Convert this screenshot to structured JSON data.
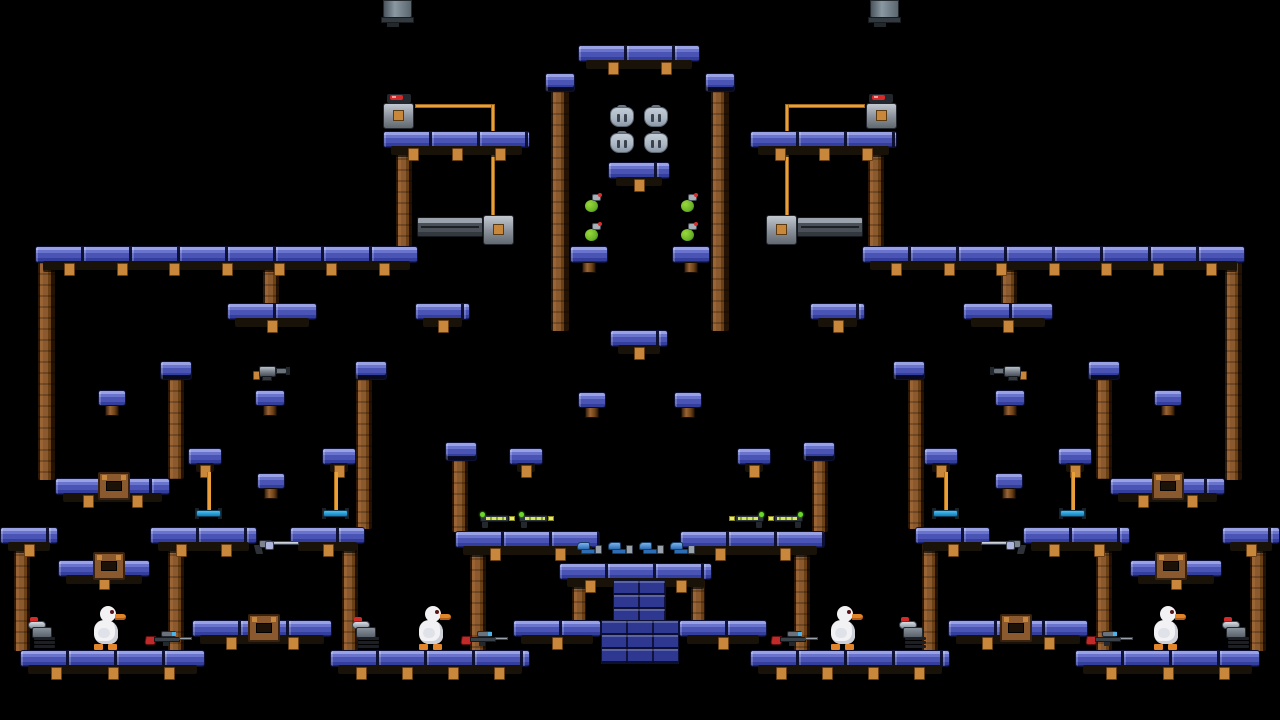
{
  "scene": {
    "name": "duck-platformer-level",
    "width": 1280,
    "height": 720,
    "background": "#000000"
  },
  "colors": {
    "background": "#000000",
    "platform_top": "#98a1e4",
    "platform_face": "#4a54b4",
    "platform_shadow": "#1c2374",
    "platform_outline": "#0c1034",
    "wood_face": "#8a5a2e",
    "beam": "#191209",
    "peg": "#c9873c",
    "wire": "#eb9f3a",
    "brick": "#2e3890",
    "duck_white": "#f2f2f4",
    "beak_orange": "#e2842a",
    "grenade_green": "#6ab428",
    "sniper_red": "#c22a2a",
    "laser_green": "#6ad828",
    "pistol_blue": "#2e6cb4",
    "trapeze_blue": "#2a9fd8",
    "metal_gray": "#8a929c",
    "door_gray": "#4a5058",
    "button_orange": "#c9873c",
    "light_red": "#d42a2a",
    "armor_silver": "#c2ccd6"
  },
  "level": {
    "platforms": [
      {
        "x": 578,
        "y": 45,
        "w": 122,
        "beam": true
      },
      {
        "x": 545,
        "y": 73,
        "w": 30,
        "style": "cap"
      },
      {
        "x": 705,
        "y": 73,
        "w": 30,
        "style": "cap"
      },
      {
        "x": 383,
        "y": 131,
        "w": 147,
        "beam": true
      },
      {
        "x": 750,
        "y": 131,
        "w": 147,
        "beam": true
      },
      {
        "x": 608,
        "y": 162,
        "w": 62,
        "beam": true
      },
      {
        "x": 570,
        "y": 246,
        "w": 38,
        "chunk": true
      },
      {
        "x": 672,
        "y": 246,
        "w": 38,
        "chunk": true
      },
      {
        "x": 35,
        "y": 246,
        "w": 383,
        "beam": true
      },
      {
        "x": 862,
        "y": 246,
        "w": 383,
        "beam": true
      },
      {
        "x": 227,
        "y": 303,
        "w": 90,
        "beam": true
      },
      {
        "x": 963,
        "y": 303,
        "w": 90,
        "beam": true
      },
      {
        "x": 415,
        "y": 303,
        "w": 55,
        "beam": true
      },
      {
        "x": 810,
        "y": 303,
        "w": 55,
        "beam": true
      },
      {
        "x": 610,
        "y": 330,
        "w": 58,
        "beam": true
      },
      {
        "x": 160,
        "y": 361,
        "w": 32,
        "style": "cap"
      },
      {
        "x": 355,
        "y": 361,
        "w": 32,
        "style": "cap"
      },
      {
        "x": 893,
        "y": 361,
        "w": 32,
        "style": "cap"
      },
      {
        "x": 1088,
        "y": 361,
        "w": 32,
        "style": "cap"
      },
      {
        "x": 98,
        "y": 390,
        "w": 28,
        "h": 16,
        "chunk": true
      },
      {
        "x": 255,
        "y": 390,
        "w": 30,
        "h": 16,
        "chunk": true
      },
      {
        "x": 578,
        "y": 392,
        "w": 28,
        "h": 16,
        "chunk": true
      },
      {
        "x": 674,
        "y": 392,
        "w": 28,
        "h": 16,
        "chunk": true
      },
      {
        "x": 995,
        "y": 390,
        "w": 30,
        "h": 16,
        "chunk": true
      },
      {
        "x": 1154,
        "y": 390,
        "w": 28,
        "h": 16,
        "chunk": true
      },
      {
        "x": 445,
        "y": 442,
        "w": 32,
        "style": "cap"
      },
      {
        "x": 803,
        "y": 442,
        "w": 32,
        "style": "cap"
      },
      {
        "x": 188,
        "y": 448,
        "w": 34,
        "beam": true
      },
      {
        "x": 322,
        "y": 448,
        "w": 34,
        "beam": true
      },
      {
        "x": 509,
        "y": 448,
        "w": 34,
        "beam": true
      },
      {
        "x": 737,
        "y": 448,
        "w": 34,
        "beam": true
      },
      {
        "x": 924,
        "y": 448,
        "w": 34,
        "beam": true
      },
      {
        "x": 1058,
        "y": 448,
        "w": 34,
        "beam": true
      },
      {
        "x": 257,
        "y": 473,
        "w": 28,
        "h": 16,
        "chunk": true
      },
      {
        "x": 995,
        "y": 473,
        "w": 28,
        "h": 16,
        "chunk": true
      },
      {
        "x": 55,
        "y": 478,
        "w": 115,
        "beam": true
      },
      {
        "x": 1110,
        "y": 478,
        "w": 115,
        "beam": true
      },
      {
        "x": 0,
        "y": 527,
        "w": 58,
        "beam": true
      },
      {
        "x": 1222,
        "y": 527,
        "w": 58,
        "beam": true
      },
      {
        "x": 150,
        "y": 527,
        "w": 107,
        "beam": true
      },
      {
        "x": 290,
        "y": 527,
        "w": 75,
        "beam": true
      },
      {
        "x": 915,
        "y": 527,
        "w": 75,
        "beam": true
      },
      {
        "x": 1023,
        "y": 527,
        "w": 107,
        "beam": true
      },
      {
        "x": 455,
        "y": 531,
        "w": 145,
        "beam": true
      },
      {
        "x": 680,
        "y": 531,
        "w": 145,
        "beam": true
      },
      {
        "x": 58,
        "y": 560,
        "w": 92,
        "beam": true
      },
      {
        "x": 1130,
        "y": 560,
        "w": 92,
        "beam": true
      },
      {
        "x": 559,
        "y": 563,
        "w": 153,
        "beam": true
      },
      {
        "x": 192,
        "y": 620,
        "w": 140,
        "beam": true
      },
      {
        "x": 948,
        "y": 620,
        "w": 140,
        "beam": true
      },
      {
        "x": 513,
        "y": 620,
        "w": 88,
        "beam": true
      },
      {
        "x": 679,
        "y": 620,
        "w": 88,
        "beam": true
      },
      {
        "x": 20,
        "y": 650,
        "w": 185,
        "beam": true
      },
      {
        "x": 330,
        "y": 650,
        "w": 200,
        "beam": true
      },
      {
        "x": 750,
        "y": 650,
        "w": 200,
        "beam": true
      },
      {
        "x": 1075,
        "y": 650,
        "w": 185,
        "beam": true
      }
    ],
    "poles": [
      {
        "x": 551,
        "y": 91,
        "w": 18,
        "h": 240
      },
      {
        "x": 711,
        "y": 91,
        "w": 18,
        "h": 240
      },
      {
        "x": 396,
        "y": 147,
        "w": 16,
        "h": 100
      },
      {
        "x": 868,
        "y": 147,
        "w": 16,
        "h": 100
      },
      {
        "x": 38,
        "y": 262,
        "w": 17,
        "h": 218
      },
      {
        "x": 1225,
        "y": 262,
        "w": 17,
        "h": 218
      },
      {
        "x": 263,
        "y": 262,
        "w": 16,
        "h": 42
      },
      {
        "x": 1001,
        "y": 262,
        "w": 16,
        "h": 42
      },
      {
        "x": 168,
        "y": 379,
        "w": 16,
        "h": 100
      },
      {
        "x": 1096,
        "y": 379,
        "w": 16,
        "h": 100
      },
      {
        "x": 356,
        "y": 379,
        "w": 16,
        "h": 150
      },
      {
        "x": 908,
        "y": 379,
        "w": 16,
        "h": 150
      },
      {
        "x": 452,
        "y": 460,
        "w": 16,
        "h": 72
      },
      {
        "x": 812,
        "y": 460,
        "w": 16,
        "h": 72
      },
      {
        "x": 14,
        "y": 543,
        "w": 16,
        "h": 108
      },
      {
        "x": 1250,
        "y": 543,
        "w": 16,
        "h": 108
      },
      {
        "x": 168,
        "y": 543,
        "w": 16,
        "h": 108
      },
      {
        "x": 1096,
        "y": 543,
        "w": 16,
        "h": 108
      },
      {
        "x": 342,
        "y": 543,
        "w": 16,
        "h": 108
      },
      {
        "x": 922,
        "y": 543,
        "w": 16,
        "h": 108
      },
      {
        "x": 470,
        "y": 547,
        "w": 16,
        "h": 104
      },
      {
        "x": 794,
        "y": 547,
        "w": 16,
        "h": 104
      },
      {
        "x": 572,
        "y": 579,
        "w": 14,
        "h": 42
      },
      {
        "x": 691,
        "y": 579,
        "w": 14,
        "h": 42
      }
    ],
    "wires": [
      {
        "x": 415,
        "y": 104,
        "w": 80,
        "h": 4
      },
      {
        "x": 491,
        "y": 104,
        "w": 4,
        "h": 114
      },
      {
        "x": 785,
        "y": 104,
        "w": 80,
        "h": 4
      },
      {
        "x": 785,
        "y": 104,
        "w": 4,
        "h": 114
      }
    ],
    "bricks": [
      {
        "x": 613,
        "y": 580,
        "w": 53,
        "h": 42
      },
      {
        "x": 601,
        "y": 620,
        "w": 78,
        "h": 44
      }
    ],
    "items": [
      {
        "type": "hanging-pipe",
        "x": 383,
        "y": 0
      },
      {
        "type": "hanging-pipe",
        "x": 870,
        "y": 0
      },
      {
        "type": "red-light",
        "x": 387,
        "y": 94
      },
      {
        "type": "red-light",
        "x": 869,
        "y": 94
      },
      {
        "type": "button-box",
        "x": 383,
        "y": 103
      },
      {
        "type": "button-box",
        "x": 866,
        "y": 103
      },
      {
        "type": "wire-box",
        "x": 483,
        "y": 215
      },
      {
        "type": "wire-box",
        "x": 766,
        "y": 215
      },
      {
        "type": "door-bar",
        "x": 417,
        "y": 217
      },
      {
        "type": "door-bar",
        "x": 797,
        "y": 217
      },
      {
        "type": "armor",
        "x": 609,
        "y": 105
      },
      {
        "type": "armor",
        "x": 643,
        "y": 105
      },
      {
        "type": "armor",
        "x": 609,
        "y": 131
      },
      {
        "type": "armor",
        "x": 643,
        "y": 131
      },
      {
        "type": "grenade",
        "x": 585,
        "y": 193
      },
      {
        "type": "grenade",
        "x": 681,
        "y": 193
      },
      {
        "type": "grenade",
        "x": 585,
        "y": 222
      },
      {
        "type": "grenade",
        "x": 681,
        "y": 222
      },
      {
        "type": "netgun",
        "x": 253,
        "y": 364
      },
      {
        "type": "netgun",
        "x": 990,
        "y": 364,
        "flip": true
      },
      {
        "type": "laser-gun",
        "x": 478,
        "y": 511
      },
      {
        "type": "laser-gun",
        "x": 517,
        "y": 511
      },
      {
        "type": "laser-gun",
        "x": 727,
        "y": 511,
        "flip": true
      },
      {
        "type": "laser-gun",
        "x": 766,
        "y": 511,
        "flip": true
      },
      {
        "type": "pistol",
        "x": 576,
        "y": 541
      },
      {
        "type": "pistol",
        "x": 607,
        "y": 541
      },
      {
        "type": "pistol",
        "x": 638,
        "y": 541
      },
      {
        "type": "pistol",
        "x": 669,
        "y": 541
      },
      {
        "type": "magnum",
        "x": 253,
        "y": 537
      },
      {
        "type": "magnum",
        "x": 980,
        "y": 537,
        "flip": true
      },
      {
        "type": "trapeze",
        "x": 195,
        "y": 472
      },
      {
        "type": "trapeze",
        "x": 322,
        "y": 472
      },
      {
        "type": "trapeze",
        "x": 932,
        "y": 472
      },
      {
        "type": "trapeze",
        "x": 1059,
        "y": 472
      },
      {
        "type": "crate",
        "x": 98,
        "y": 472
      },
      {
        "type": "crate",
        "x": 1152,
        "y": 472
      },
      {
        "type": "crate",
        "x": 93,
        "y": 552
      },
      {
        "type": "crate",
        "x": 1155,
        "y": 552
      },
      {
        "type": "crate",
        "x": 248,
        "y": 614
      },
      {
        "type": "crate",
        "x": 1000,
        "y": 614
      },
      {
        "type": "duck",
        "x": 90,
        "y": 606
      },
      {
        "type": "duck",
        "x": 415,
        "y": 606
      },
      {
        "type": "duck",
        "x": 827,
        "y": 606
      },
      {
        "type": "duck",
        "x": 1150,
        "y": 606
      },
      {
        "type": "chaingun",
        "x": 28,
        "y": 617
      },
      {
        "type": "chaingun",
        "x": 352,
        "y": 617
      },
      {
        "type": "chaingun",
        "x": 899,
        "y": 617
      },
      {
        "type": "chaingun",
        "x": 1222,
        "y": 617
      },
      {
        "type": "sniper-rifle",
        "x": 145,
        "y": 630
      },
      {
        "type": "sniper-rifle",
        "x": 461,
        "y": 630
      },
      {
        "type": "sniper-rifle",
        "x": 771,
        "y": 630
      },
      {
        "type": "sniper-rifle",
        "x": 1086,
        "y": 630
      }
    ]
  }
}
